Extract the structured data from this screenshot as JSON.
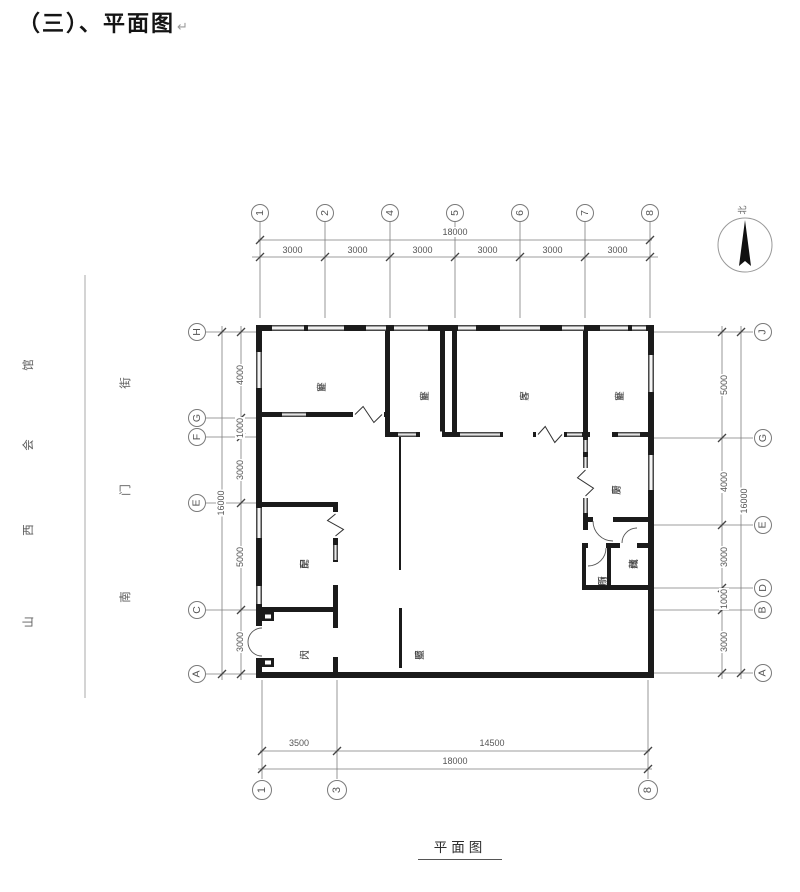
{
  "title": "（三）、平面图",
  "paragraph_mark": "↵",
  "caption": "平面图",
  "compass": {
    "label": "北"
  },
  "boundary_labels": {
    "outer_column_top_to_bottom": [
      "馆",
      "会",
      "西",
      "山"
    ],
    "inner_column_top_to_bottom": [
      "街",
      "门",
      "南"
    ]
  },
  "grid": {
    "top": {
      "bubbles": [
        "1",
        "2",
        "4",
        "5",
        "6",
        "7",
        "8"
      ],
      "overall": "18000",
      "segments": [
        "3000",
        "3000",
        "3000",
        "3000",
        "3000",
        "3000"
      ]
    },
    "bottom": {
      "bubbles": [
        "1",
        "3",
        "8"
      ],
      "overall": "18000",
      "segments": [
        "3500",
        "14500"
      ]
    },
    "left": {
      "bubbles": [
        "H",
        "G",
        "F",
        "E",
        "C",
        "A"
      ],
      "overall": "16000",
      "segments": [
        "4000",
        "1000",
        "3000",
        "5000",
        "3000"
      ]
    },
    "right": {
      "bubbles": [
        "J",
        "G",
        "E",
        "D",
        "B",
        "A"
      ],
      "overall": "16000",
      "segments": [
        "5000",
        "4000",
        "3000",
        "1000",
        "3000"
      ]
    }
  },
  "rooms": {
    "bedroom_west": "卧室",
    "bedroom_mid": "卧室",
    "living_room": "客厅",
    "bedroom_east": "卧室",
    "kitchen": "厨房",
    "side_room": "配房",
    "gate": "大门",
    "screen_wall": "照壁",
    "toilet": "厕所",
    "storage": "储藏"
  }
}
